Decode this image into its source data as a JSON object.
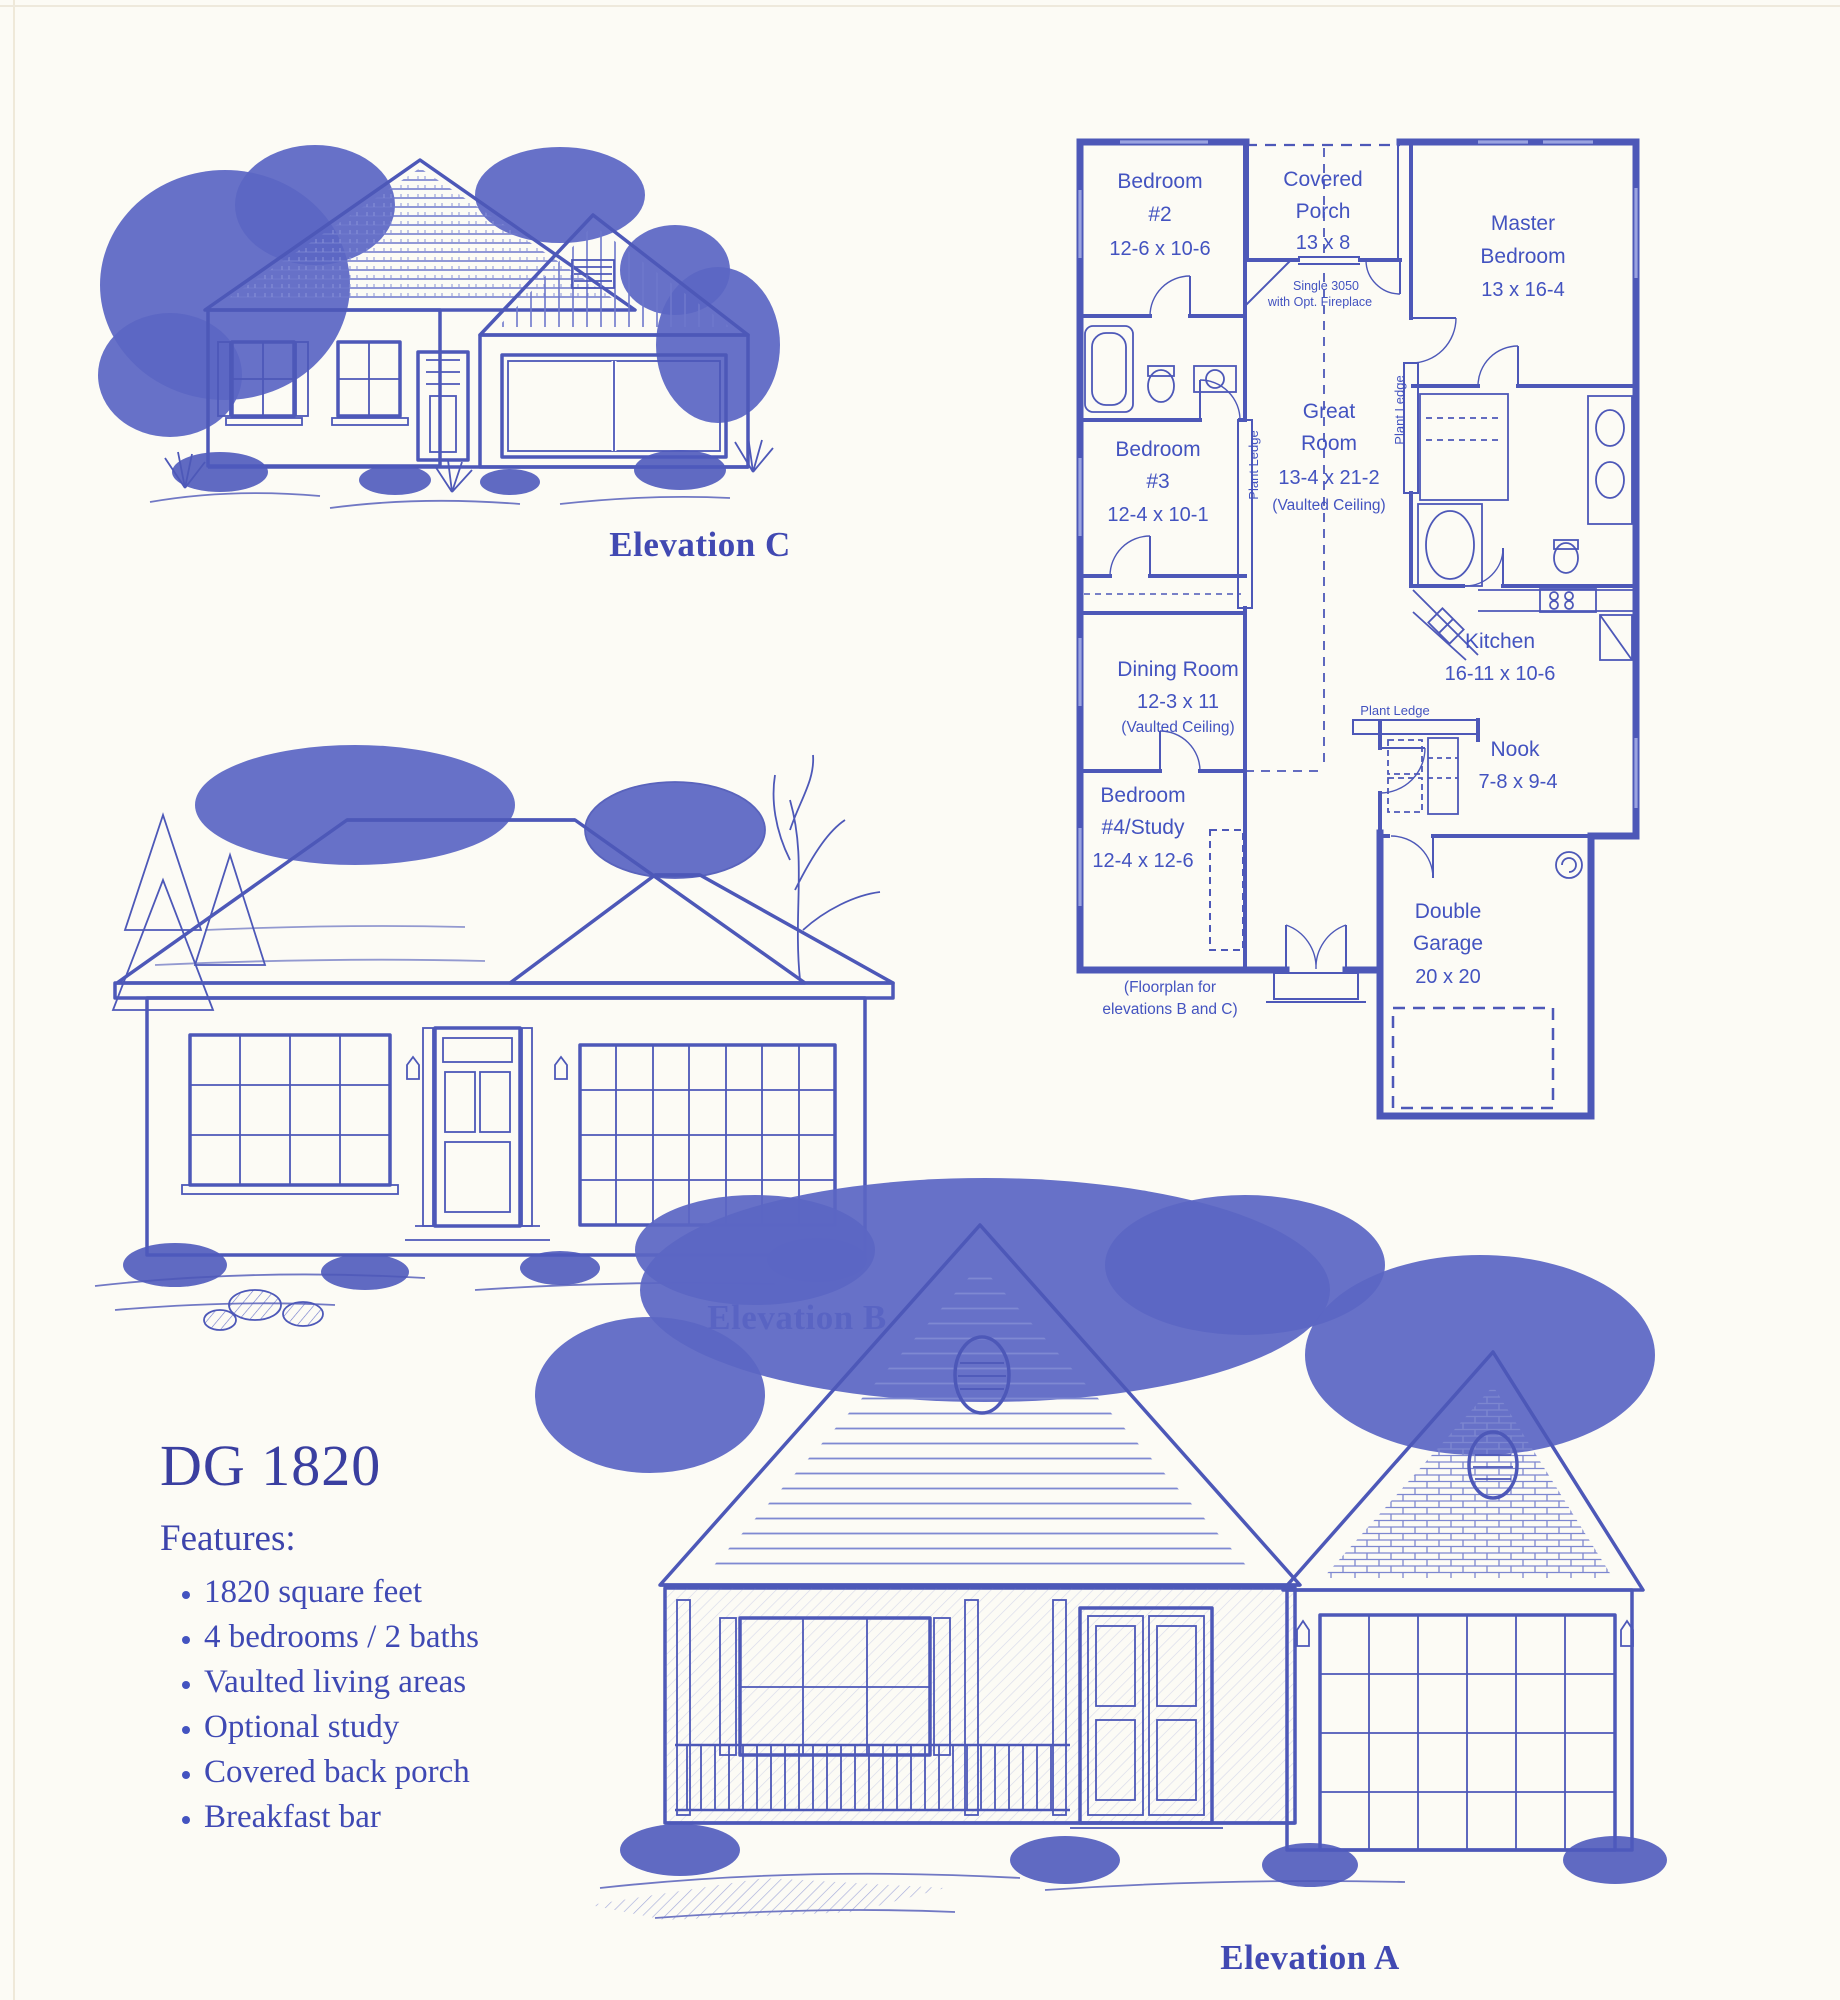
{
  "colors": {
    "paper": "#fcfbf5",
    "ink": "#4d58b8",
    "plan-text": "#4353c0",
    "heading": "#3a41a4",
    "caption": "#4149b2",
    "foliage": "#5b66c4"
  },
  "captions": {
    "elevation_c": "Elevation C",
    "elevation_b": "Elevation B",
    "elevation_a": "Elevation A"
  },
  "info": {
    "model": "DG 1820",
    "features_heading": "Features:",
    "features": [
      "1820 square feet",
      "4 bedrooms / 2 baths",
      "Vaulted living areas",
      "Optional study",
      "Covered back porch",
      "Breakfast bar"
    ]
  },
  "floorplan": {
    "rooms": {
      "bedroom2": {
        "name1": "Bedroom",
        "name2": "#2",
        "dims": "12-6 x 10-6"
      },
      "covered_porch": {
        "name1": "Covered",
        "name2": "Porch",
        "dims": "13 x 8"
      },
      "master": {
        "name1": "Master",
        "name2": "Bedroom",
        "dims": "13 x 16-4"
      },
      "bedroom3": {
        "name1": "Bedroom",
        "name2": "#3",
        "dims": "12-4 x 10-1"
      },
      "great_room": {
        "name1": "Great",
        "name2": "Room",
        "dims": "13-4 x 21-2",
        "note": "(Vaulted Ceiling)"
      },
      "kitchen": {
        "name1": "Kitchen",
        "dims": "16-11 x 10-6"
      },
      "dining": {
        "name1": "Dining Room",
        "dims": "12-3 x 11",
        "note": "(Vaulted Ceiling)"
      },
      "nook": {
        "name1": "Nook",
        "dims": "7-8 x 9-4"
      },
      "bedroom4": {
        "name1": "Bedroom",
        "name2": "#4/Study",
        "dims": "12-4 x 12-6"
      },
      "garage": {
        "name1": "Double",
        "name2": "Garage",
        "dims": "20 x 20"
      }
    },
    "annotations": {
      "window_note1": "Single 3050",
      "window_note2": "with Opt. Fireplace",
      "plant_ledge": "Plant Ledge",
      "plan_note1": "(Floorplan for",
      "plan_note2": "elevations B and C)"
    }
  }
}
